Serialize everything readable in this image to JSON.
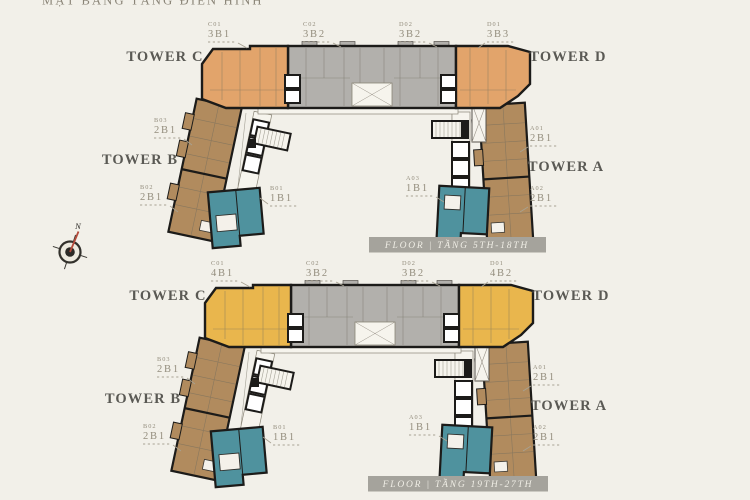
{
  "page": {
    "top_title": "MẶT BẰNG TẦNG ĐIỂN HÌNH"
  },
  "compass": {
    "north_label": "N"
  },
  "colors": {
    "background": "#f2f0e9",
    "outline": "#1c1b19",
    "unit_gray": "#b2b0ac",
    "unit_tan": "#b18b5e",
    "unit_teal": "#4f929e",
    "unit_orange": "#e2a46b",
    "unit_gold": "#e9b64d",
    "banner_bg": "#a5a39c",
    "banner_text": "#efede5",
    "tower_label": "#5a5954",
    "unit_label": "#938d7d"
  },
  "plans": [
    {
      "name": "floors-5th-18th",
      "banner_label": "FLOOR | TẦNG 5TH-18TH",
      "end_unit_color": "#e2a46b",
      "towers": {
        "c": "TOWER C",
        "d": "TOWER D",
        "b": "TOWER B",
        "a": "TOWER A"
      },
      "units": {
        "c01": {
          "code": "C01",
          "type": "3B1"
        },
        "c02": {
          "code": "C02",
          "type": "3B2"
        },
        "d02": {
          "code": "D02",
          "type": "3B2"
        },
        "d01": {
          "code": "D01",
          "type": "3B3"
        },
        "b03": {
          "code": "B03",
          "type": "2B1"
        },
        "b02": {
          "code": "B02",
          "type": "2B1"
        },
        "b01": {
          "code": "B01",
          "type": "1B1"
        },
        "a01": {
          "code": "A01",
          "type": "2B1"
        },
        "a02": {
          "code": "A02",
          "type": "2B1"
        },
        "a03": {
          "code": "A03",
          "type": "1B1"
        }
      }
    },
    {
      "name": "floors-19th-27th",
      "banner_label": "FLOOR | TẦNG 19TH-27TH",
      "end_unit_color": "#e9b64d",
      "towers": {
        "c": "TOWER C",
        "d": "TOWER D",
        "b": "TOWER B",
        "a": "TOWER A"
      },
      "units": {
        "c01": {
          "code": "C01",
          "type": "4B1"
        },
        "c02": {
          "code": "C02",
          "type": "3B2"
        },
        "d02": {
          "code": "D02",
          "type": "3B2"
        },
        "d01": {
          "code": "D01",
          "type": "4B2"
        },
        "b03": {
          "code": "B03",
          "type": "2B1"
        },
        "b02": {
          "code": "B02",
          "type": "2B1"
        },
        "b01": {
          "code": "B01",
          "type": "1B1"
        },
        "a01": {
          "code": "A01",
          "type": "2B1"
        },
        "a02": {
          "code": "A02",
          "type": "2B1"
        },
        "a03": {
          "code": "A03",
          "type": "1B1"
        }
      }
    }
  ]
}
